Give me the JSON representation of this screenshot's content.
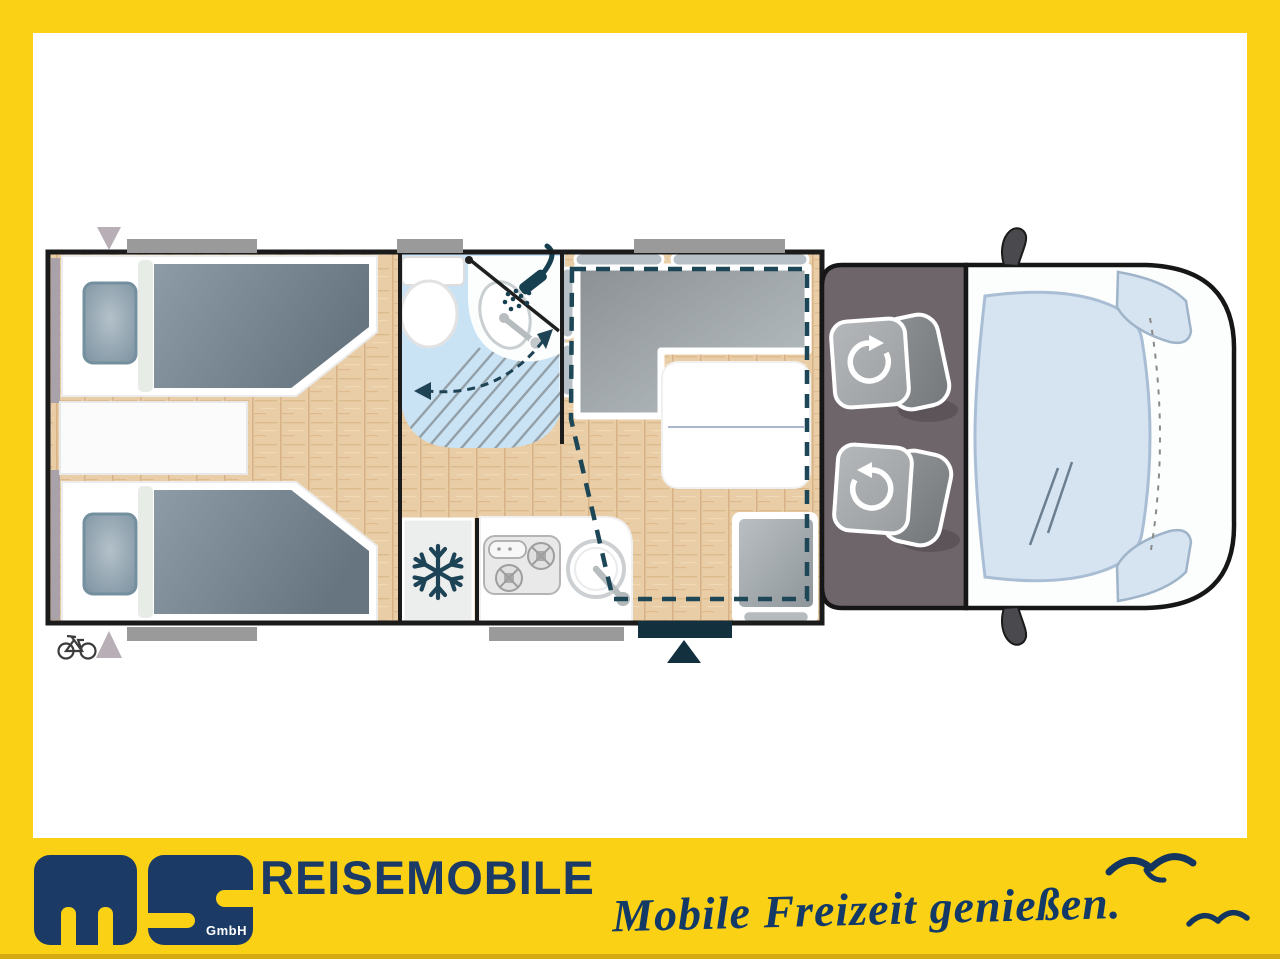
{
  "branding": {
    "logo_m": "m",
    "logo_s": "S",
    "logo_suffix": "GmbH",
    "brand_text": "REISEMOBILE",
    "tagline": "Mobile Freizeit genießen."
  },
  "colors": {
    "frame_yellow": "#fbd116",
    "brand_navy": "#1b3a66",
    "plan_icon_navy": "#16404f",
    "dashed_bed_outline": "#1d4657",
    "entry_door_navy": "#13303f",
    "wall_black": "#1b1b1b",
    "wood_floor": "#e9cda6",
    "bathroom_blue": "#c9e2f4",
    "glass_blue": "#d6e4f2",
    "upholstery_gray": "#9aa0a4",
    "duvet_blue_gray": "#74828e",
    "cab_floor_gray": "#6e656b",
    "window_bar_gray": "#9a9a9a"
  },
  "floorplan": {
    "icons": [
      "shower-icon",
      "snowflake-icon",
      "bicycle-icon",
      "swivel-arrow-icon",
      "entry-arrow-icon",
      "rear-hatch-arrow-icon",
      "drop-down-bed-outline",
      "seagull-icon"
    ]
  }
}
